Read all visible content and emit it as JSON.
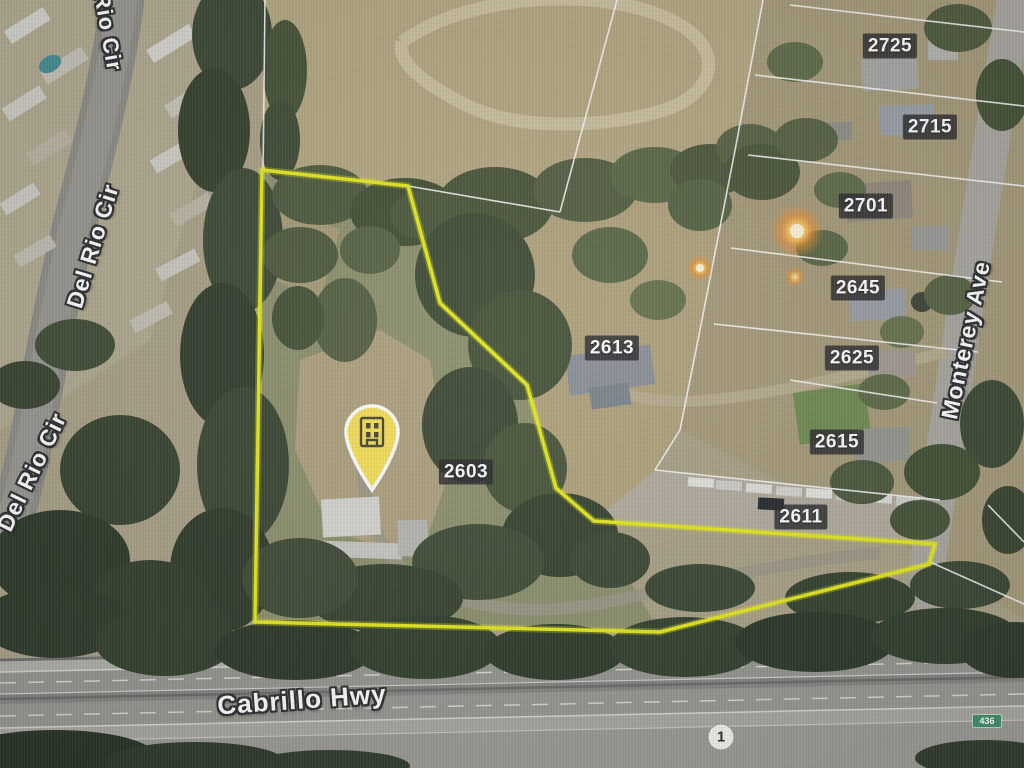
{
  "map": {
    "view": {
      "description": "Aerial satellite parcel map with highlighted property boundary",
      "width": 1024,
      "height": 768
    },
    "parcel_labels": [
      {
        "text": "2725",
        "x": 890,
        "y": 46
      },
      {
        "text": "2715",
        "x": 930,
        "y": 127
      },
      {
        "text": "2701",
        "x": 866,
        "y": 206
      },
      {
        "text": "2645",
        "x": 858,
        "y": 288
      },
      {
        "text": "2625",
        "x": 852,
        "y": 358
      },
      {
        "text": "2615",
        "x": 837,
        "y": 442
      },
      {
        "text": "2613",
        "x": 612,
        "y": 348
      },
      {
        "text": "2603",
        "x": 466,
        "y": 472
      },
      {
        "text": "2611",
        "x": 801,
        "y": 517
      }
    ],
    "street_labels": [
      {
        "text": "Del Rio Cir",
        "x": 104,
        "y": 10,
        "rotation": 80,
        "size": 22,
        "note": "cut off at top edge"
      },
      {
        "text": "Del Rio Cir",
        "x": 93,
        "y": 246,
        "rotation": -73,
        "size": 23
      },
      {
        "text": "Del Rio Cir",
        "x": 32,
        "y": 472,
        "rotation": -64,
        "size": 23
      },
      {
        "text": "Monterey Ave",
        "x": 966,
        "y": 340,
        "rotation": -78,
        "size": 23
      },
      {
        "text": "Cabrillo Hwy",
        "x": 302,
        "y": 700,
        "rotation": -4,
        "size": 26
      }
    ],
    "route_shields": {
      "state_route": {
        "text": "1",
        "x": 721,
        "y": 737
      },
      "exit_sign": {
        "text": "436",
        "x": 987,
        "y": 721
      }
    },
    "pin": {
      "icon": "building",
      "tip_x": 372,
      "tip_y": 490
    },
    "boundary": {
      "color": "#e8ed0a",
      "points": [
        [
          262,
          170
        ],
        [
          408,
          186
        ],
        [
          440,
          303
        ],
        [
          527,
          385
        ],
        [
          556,
          488
        ],
        [
          594,
          521
        ],
        [
          935,
          544
        ],
        [
          929,
          564
        ],
        [
          862,
          581
        ],
        [
          660,
          632
        ],
        [
          255,
          622
        ]
      ]
    },
    "colors": {
      "boundary_yellow": "#e8ed0a",
      "pin_yellow": "#f6df57",
      "badge_background": "#28282a",
      "street_text": "#ffffff",
      "exit_sign_green": "#3e8e67",
      "route_shield_white": "#f2f2ec"
    }
  }
}
